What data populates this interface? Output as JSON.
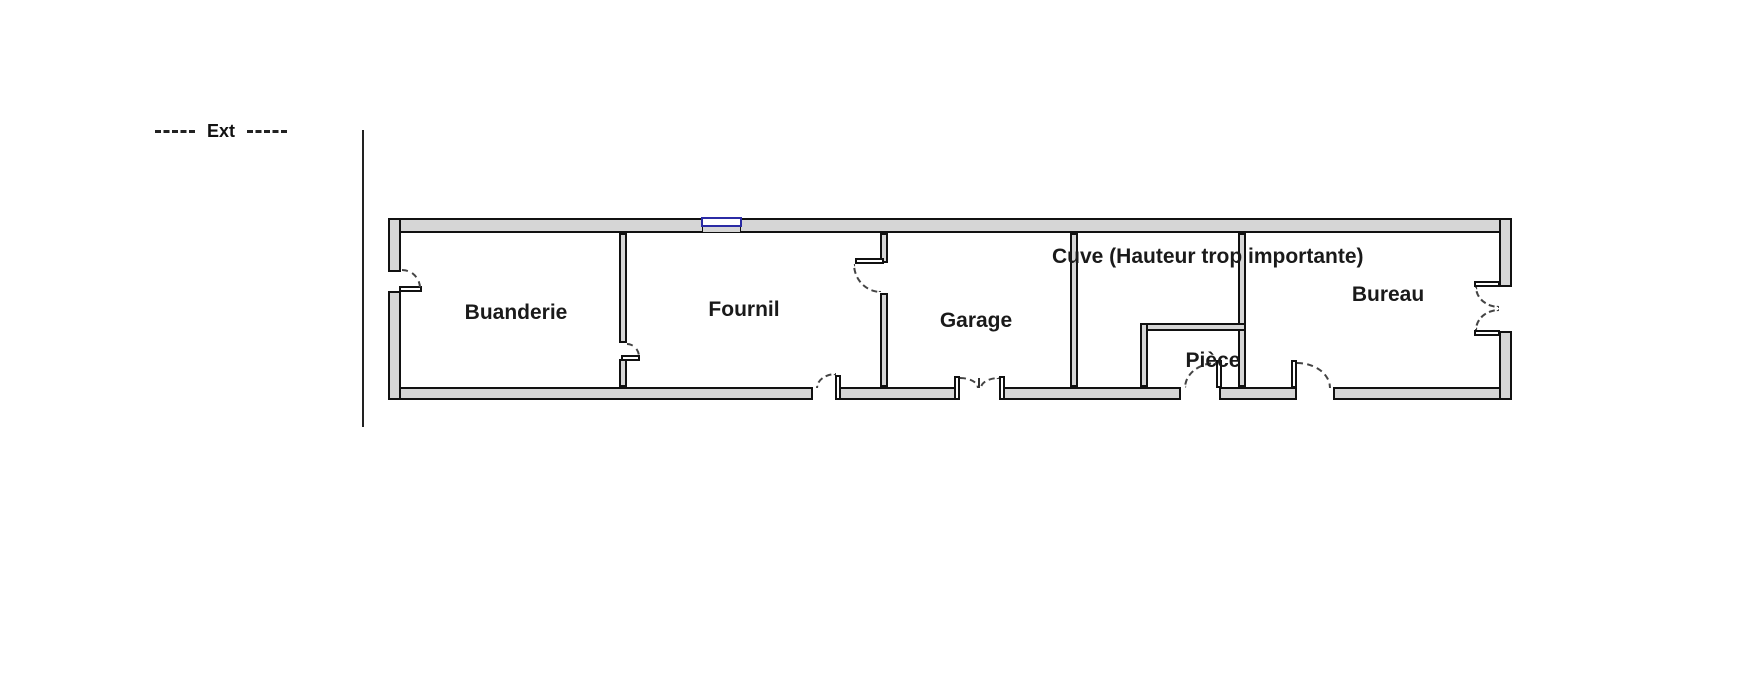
{
  "legend": {
    "label": "Ext"
  },
  "rooms": [
    {
      "name": "Buanderie"
    },
    {
      "name": "Fournil"
    },
    {
      "name": "Garage"
    },
    {
      "name": "Cuve (Hauteur trop importante)"
    },
    {
      "name": "Pièce"
    },
    {
      "name": "Bureau"
    }
  ],
  "features": {
    "window": "Fournil window (top wall)",
    "doors": [
      "Buanderie exterior door (left wall)",
      "Buanderie-Fournil door",
      "Fournil-Garage door",
      "Fournil exterior door (bottom wall)",
      "Garage double exterior door (bottom wall)",
      "Pièce exterior door (bottom wall)",
      "Bureau exterior door (bottom wall)",
      "Bureau French double door (right wall)"
    ]
  },
  "colors": {
    "wall_fill": "#d6d6d6",
    "wall_line": "#111111",
    "window_frame": "#2b2ba5",
    "text": "#1a1a1a",
    "background": "#ffffff"
  }
}
